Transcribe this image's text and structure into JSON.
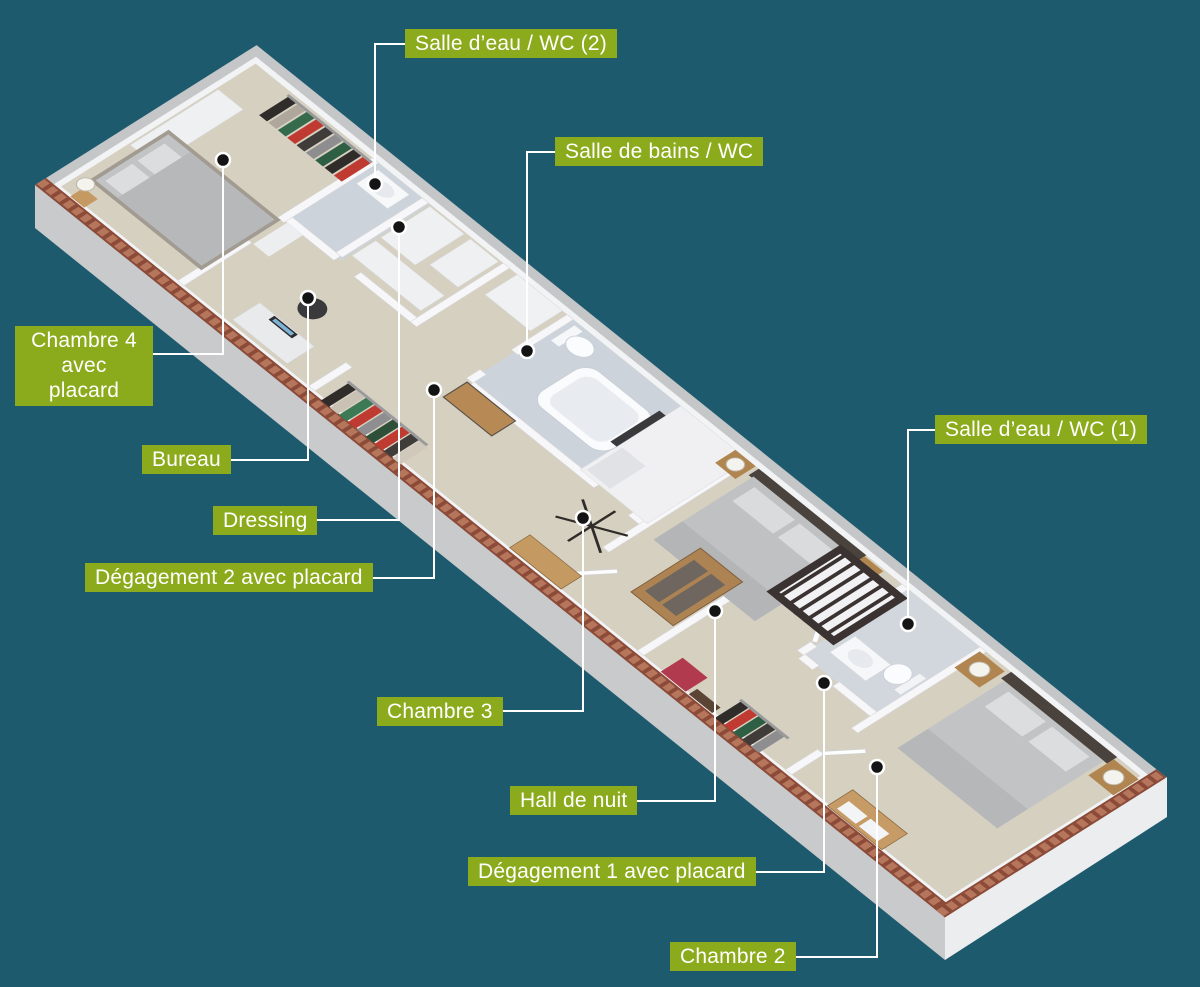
{
  "figure": {
    "type": "3d-floor-plan",
    "labels_language": "fr"
  },
  "colors": {
    "background": "#1e5a6e",
    "label_bg": "#8cab1c",
    "label_text": "#ffffff",
    "leader_line": "#ffffff",
    "dot_fill": "#141414",
    "dot_ring": "#ffffff",
    "floor_beige": "#d6d0c1",
    "floor_bath": "#ccd3db",
    "brick": "#8c4a38",
    "wall_white": "#f2f3f5",
    "wall_top_gray": "#c5c6c8"
  },
  "annotations": [
    {
      "id": "salle-eau-wc-2",
      "label": "Salle d’eau / WC (2)",
      "box": {
        "left": 405,
        "top": 29
      },
      "line": "414,44 375,44 375,184",
      "dot": [
        375,
        184
      ]
    },
    {
      "id": "salle-de-bains-wc",
      "label": "Salle de bains / WC",
      "box": {
        "left": 555,
        "top": 137
      },
      "line": "562,152 527,152 527,351",
      "dot": [
        527,
        351
      ]
    },
    {
      "id": "chambre-4",
      "label": "Chambre 4\navec placard",
      "box": {
        "left": 15,
        "top": 326,
        "width": 138,
        "centered": true
      },
      "line": "146,354 223,354 223,160",
      "dot": [
        223,
        160
      ]
    },
    {
      "id": "bureau",
      "label": "Bureau",
      "box": {
        "left": 142,
        "top": 445
      },
      "line": "224,460 308,460 308,298",
      "dot": [
        308,
        298
      ]
    },
    {
      "id": "dressing",
      "label": "Dressing",
      "box": {
        "left": 213,
        "top": 506
      },
      "line": "314,520 399,520 399,227",
      "dot": [
        399,
        227
      ]
    },
    {
      "id": "degagement-2",
      "label": "Dégagement 2 avec placard",
      "box": {
        "left": 85,
        "top": 563
      },
      "line": "348,578 434,578 434,390",
      "dot": [
        434,
        390
      ]
    },
    {
      "id": "salle-eau-wc-1",
      "label": "Salle d’eau / WC (1)",
      "box": {
        "left": 935,
        "top": 415
      },
      "line": "942,430 908,430 908,624",
      "dot": [
        908,
        624
      ]
    },
    {
      "id": "chambre-3",
      "label": "Chambre 3",
      "box": {
        "left": 377,
        "top": 697
      },
      "line": "496,711 583,711 583,518",
      "dot": [
        583,
        518
      ]
    },
    {
      "id": "hall-de-nuit",
      "label": "Hall de nuit",
      "box": {
        "left": 510,
        "top": 786
      },
      "line": "630,801 715,801 715,611",
      "dot": [
        715,
        611
      ]
    },
    {
      "id": "degagement-1",
      "label": "Dégagement 1 avec placard",
      "box": {
        "left": 468,
        "top": 857
      },
      "line": "740,872 824,872 824,683",
      "dot": [
        824,
        683
      ]
    },
    {
      "id": "chambre-2",
      "label": "Chambre 2",
      "box": {
        "left": 670,
        "top": 942
      },
      "line": "790,957 877,957 877,767",
      "dot": [
        877,
        767
      ]
    }
  ]
}
